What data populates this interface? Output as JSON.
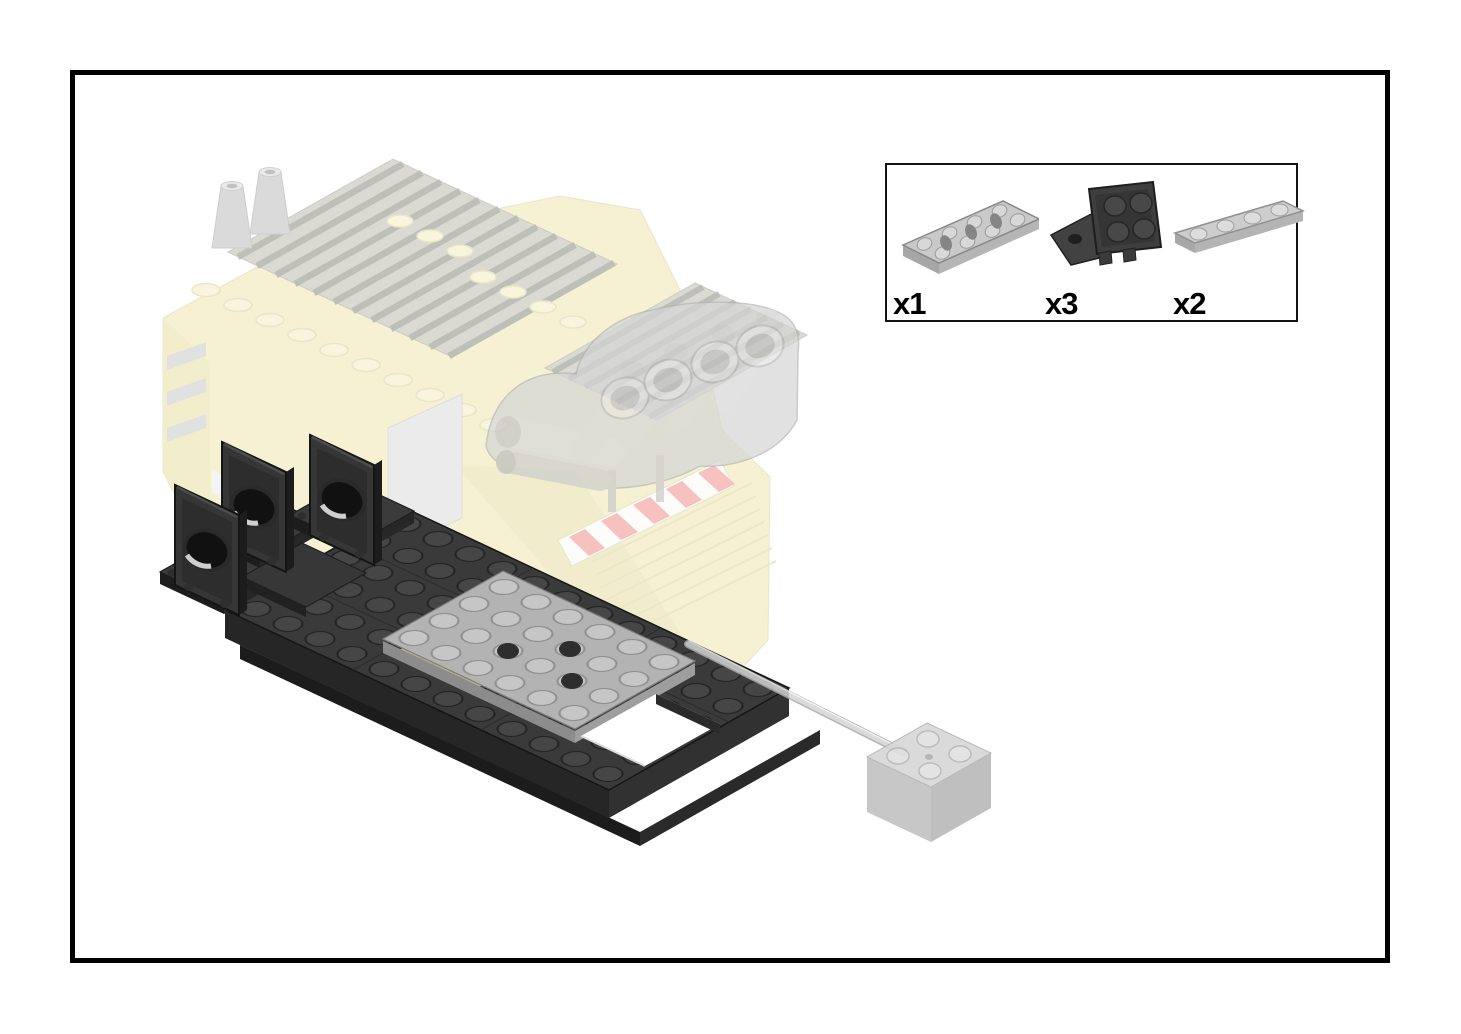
{
  "page": {
    "background_color": "#ffffff",
    "frame_border_color": "#000000"
  },
  "parts_callout": {
    "border_color": "#141414",
    "background_color": "#ffffff",
    "parts": [
      {
        "part": "plate-2x4-with-holes",
        "color_name": "light-gray",
        "color_hex": "#c9c9c9",
        "quantity_label": "x1"
      },
      {
        "part": "bracket-2x2-2x2-inverted",
        "color_name": "dark-gray",
        "color_hex": "#3a3a3a",
        "quantity_label": "x3"
      },
      {
        "part": "plate-1x4",
        "color_name": "light-gray",
        "color_hex": "#cdcdcd",
        "quantity_label": "x2"
      }
    ]
  },
  "illustration": {
    "subject": "truck-chassis-assembly-step",
    "ghost_body_color_hex": "#eee7ae",
    "ghost_gray_color_hex": "#d2d2d2",
    "chassis_color_hex": "#3a3a3a",
    "new_plate_color_hex": "#b3b3b3",
    "hazard_stripe_color_hex": "#ef8f8b"
  }
}
